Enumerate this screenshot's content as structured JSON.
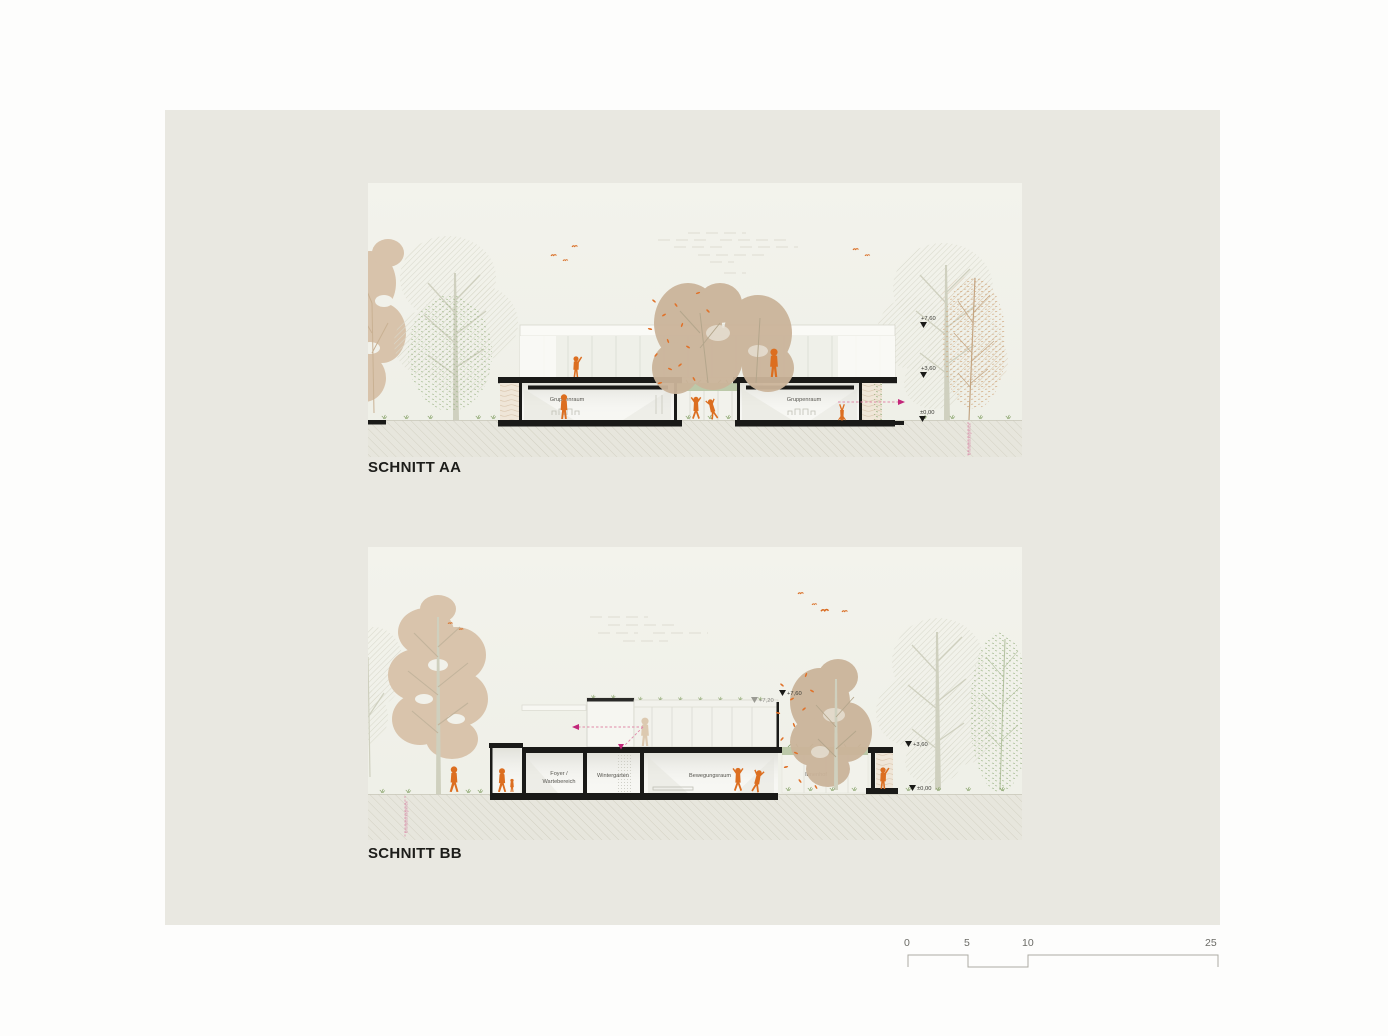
{
  "sections": [
    {
      "id": "AA",
      "title": "SCHNITT AA",
      "rooms": {
        "left": "Gruppenraum",
        "right": "Gruppenraum"
      },
      "elevations": {
        "e1": "+7,60",
        "e2": "+3,60",
        "e3": "±0,00"
      },
      "property_line": "Grundstücksgrenze"
    },
    {
      "id": "BB",
      "title": "SCHNITT BB",
      "rooms": {
        "foyer_line1": "Foyer /",
        "foyer_line2": "Wartebereich",
        "wintergarten": "Wintergarten",
        "bewegungsraum": "Bewegungsraum",
        "innenhof": "Innenhof"
      },
      "elevations": {
        "top_outer": "+7,60",
        "top_inner": "+7,20",
        "right_upper": "+3,60",
        "right_ground": "±0,00"
      },
      "property_line": "Grundstücksgrenze"
    }
  ],
  "scale_bar": {
    "labels": [
      "0",
      "5",
      "10",
      "25"
    ]
  },
  "colors": {
    "board": "#e9e8e1",
    "panel": "#f1f1ea",
    "accent_orange": "#dc6e20",
    "accent_magenta": "#c2267a",
    "ink": "#1a1a18"
  }
}
